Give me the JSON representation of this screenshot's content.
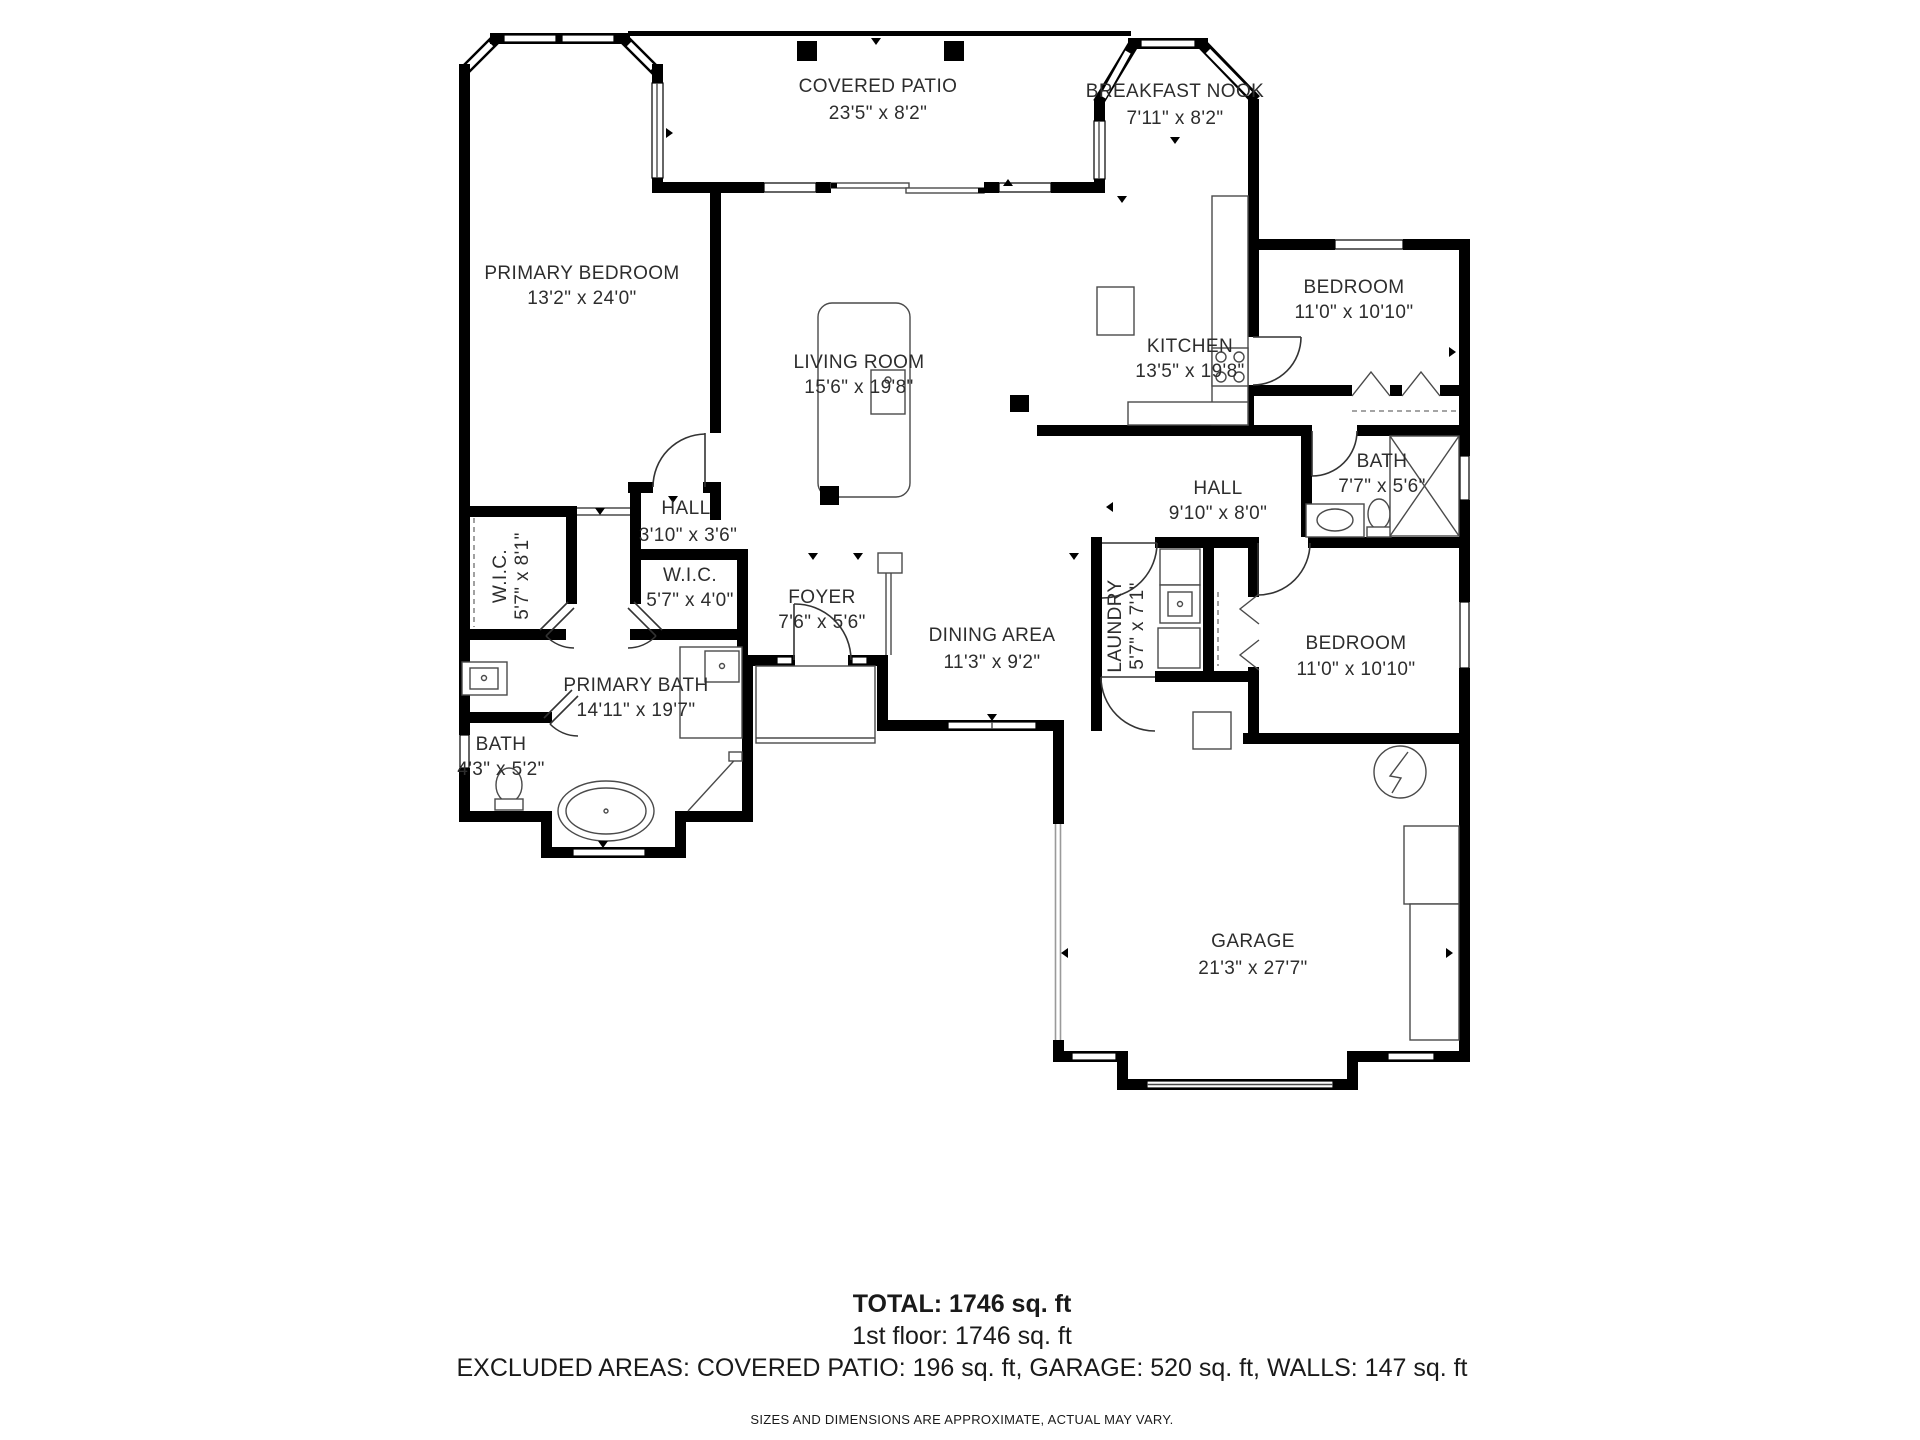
{
  "colors": {
    "wall": "#000000",
    "line": "#4a4a4a",
    "door": "#333333",
    "muted_wall": "#9a9a9a",
    "text": "#2d2d2d"
  },
  "rooms": {
    "covered_patio": {
      "name": "COVERED PATIO",
      "dims": "23'5\" x 8'2\""
    },
    "breakfast_nook": {
      "name": "BREAKFAST NOOK",
      "dims": "7'11\" x 8'2\""
    },
    "primary_bedroom": {
      "name": "PRIMARY BEDROOM",
      "dims": "13'2\" x 24'0\""
    },
    "living_room": {
      "name": "LIVING ROOM",
      "dims": "15'6\" x 19'8\""
    },
    "kitchen": {
      "name": "KITCHEN",
      "dims": "13'5\" x 19'8\""
    },
    "bedroom_top": {
      "name": "BEDROOM",
      "dims": "11'0\" x 10'10\""
    },
    "hall_small": {
      "name": "HALL",
      "dims": "3'10\" x 3'6\""
    },
    "wic_large": {
      "name": "W.I.C.",
      "dims": "5'7\" x 8'1\""
    },
    "wic_small": {
      "name": "W.I.C.",
      "dims": "5'7\" x 4'0\""
    },
    "foyer": {
      "name": "FOYER",
      "dims": "7'6\" x 5'6\""
    },
    "primary_bath": {
      "name": "PRIMARY BATH",
      "dims": "14'11\" x 19'7\""
    },
    "bath_small": {
      "name": "BATH",
      "dims": "4'3\" x 5'2\""
    },
    "dining_area": {
      "name": "DINING AREA",
      "dims": "11'3\" x 9'2\""
    },
    "hall_main": {
      "name": "HALL",
      "dims": "9'10\" x 8'0\""
    },
    "bath_right": {
      "name": "BATH",
      "dims": "7'7\" x 5'6\""
    },
    "laundry": {
      "name": "LAUNDRY",
      "dims": "5'7\" x 7'1\""
    },
    "bedroom_bottom": {
      "name": "BEDROOM",
      "dims": "11'0\" x 10'10\""
    },
    "garage": {
      "name": "GARAGE",
      "dims": "21'3\" x 27'7\""
    }
  },
  "footer": {
    "total": "TOTAL: 1746 sq. ft",
    "floor1": "1st floor: 1746 sq. ft",
    "excluded": "EXCLUDED AREAS: COVERED PATIO: 196 sq. ft, GARAGE: 520 sq. ft, WALLS: 147 sq. ft",
    "disclaimer": "SIZES AND DIMENSIONS ARE APPROXIMATE, ACTUAL MAY VARY."
  }
}
